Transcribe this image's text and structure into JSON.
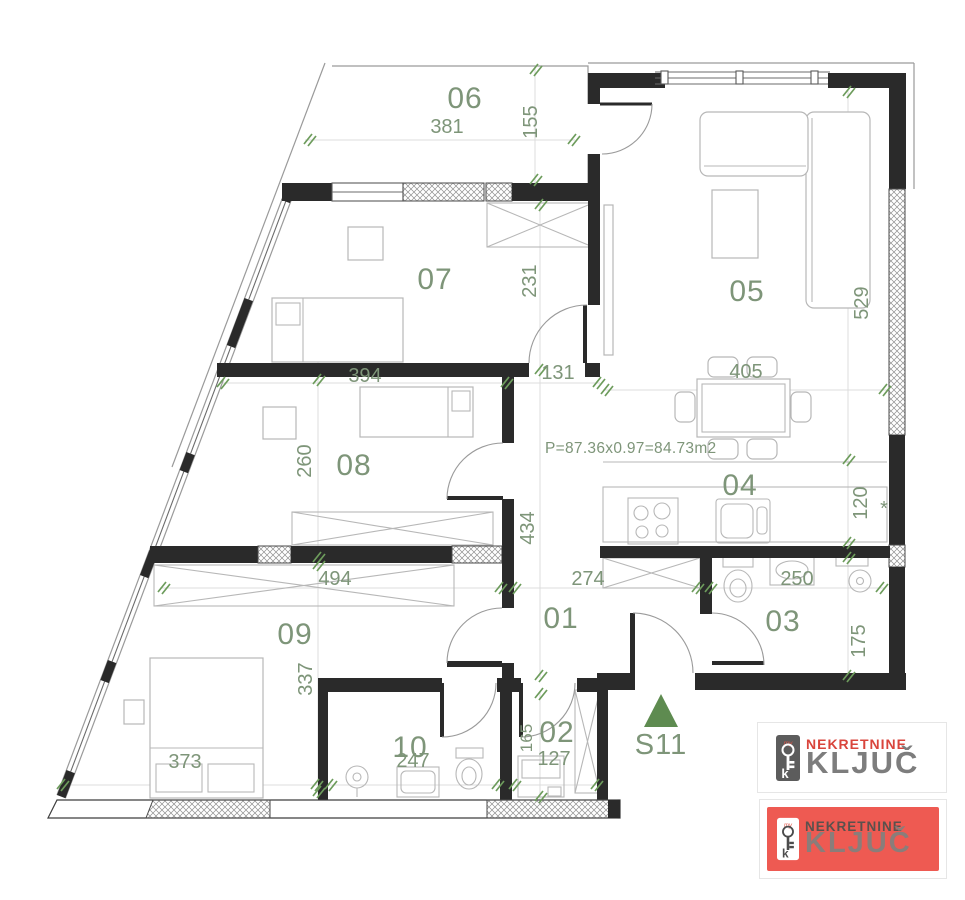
{
  "plan": {
    "area_formula": "P=87.36x0.97=84.73m2",
    "section_label": "S11",
    "rooms": [
      {
        "id": "06"
      },
      {
        "id": "07"
      },
      {
        "id": "05"
      },
      {
        "id": "08"
      },
      {
        "id": "04"
      },
      {
        "id": "01"
      },
      {
        "id": "03"
      },
      {
        "id": "09"
      },
      {
        "id": "10"
      },
      {
        "id": "02"
      }
    ],
    "dimensions": [
      "381",
      "155",
      "394",
      "231",
      "131",
      "405",
      "529",
      "260",
      "434",
      "120",
      "494",
      "274",
      "250",
      "175",
      "337",
      "373",
      "247",
      "127",
      "165",
      "*"
    ]
  },
  "logo": {
    "top": {
      "brand_line1": "NEKRETNINE",
      "brand_line2": "KLJUČ",
      "icon_small_text": "my",
      "icon_letter": "k"
    },
    "bottom": {
      "brand_line1": "NEKRETNINE",
      "brand_line2": "KLJUČ",
      "icon_small_text": "my",
      "icon_letter": "k"
    }
  },
  "colors": {
    "dim_green": "#7e9579",
    "tick_green": "#6d9c5c",
    "triangle_green": "#5e8b50",
    "wall_dark": "#2a2a2a",
    "logo_red": "#d9453c",
    "logo_card_red": "#ee5a52",
    "logo_gray": "#7d7d7d"
  }
}
